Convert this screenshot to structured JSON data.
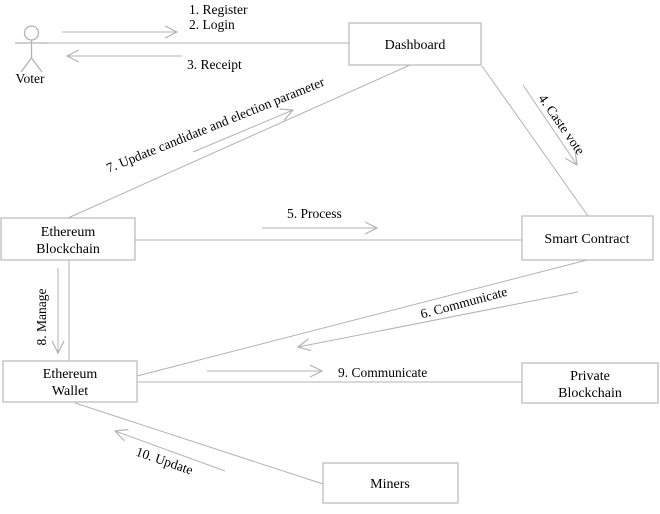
{
  "diagram": {
    "title": "Blockchain e-voting communication diagram",
    "actor": {
      "label": "Voter"
    },
    "nodes": {
      "dashboard": {
        "label": "Dashboard"
      },
      "ethereum_blockchain": {
        "line1": "Ethereum",
        "line2": "Blockchain"
      },
      "smart_contract": {
        "label": "Smart Contract"
      },
      "ethereum_wallet": {
        "line1": "Ethereum",
        "line2": "Wallet"
      },
      "private_blockchain": {
        "line1": "Private",
        "line2": "Blockchain"
      },
      "miners": {
        "label": "Miners"
      }
    },
    "messages": {
      "m1": "1. Register",
      "m2": "2. Login",
      "m3": "3. Receipt",
      "m4": "4. Caste vote",
      "m5": "5. Process",
      "m6": "6. Communicate",
      "m7": "7. Update candidate and election parameter",
      "m8": "8. Manage",
      "m9": "9. Communicate",
      "m10": "10. Update"
    },
    "colors": {
      "line": "#b3b3b3",
      "box_border": "#b9b9b9",
      "text": "#000000",
      "background": "#ffffff"
    }
  }
}
